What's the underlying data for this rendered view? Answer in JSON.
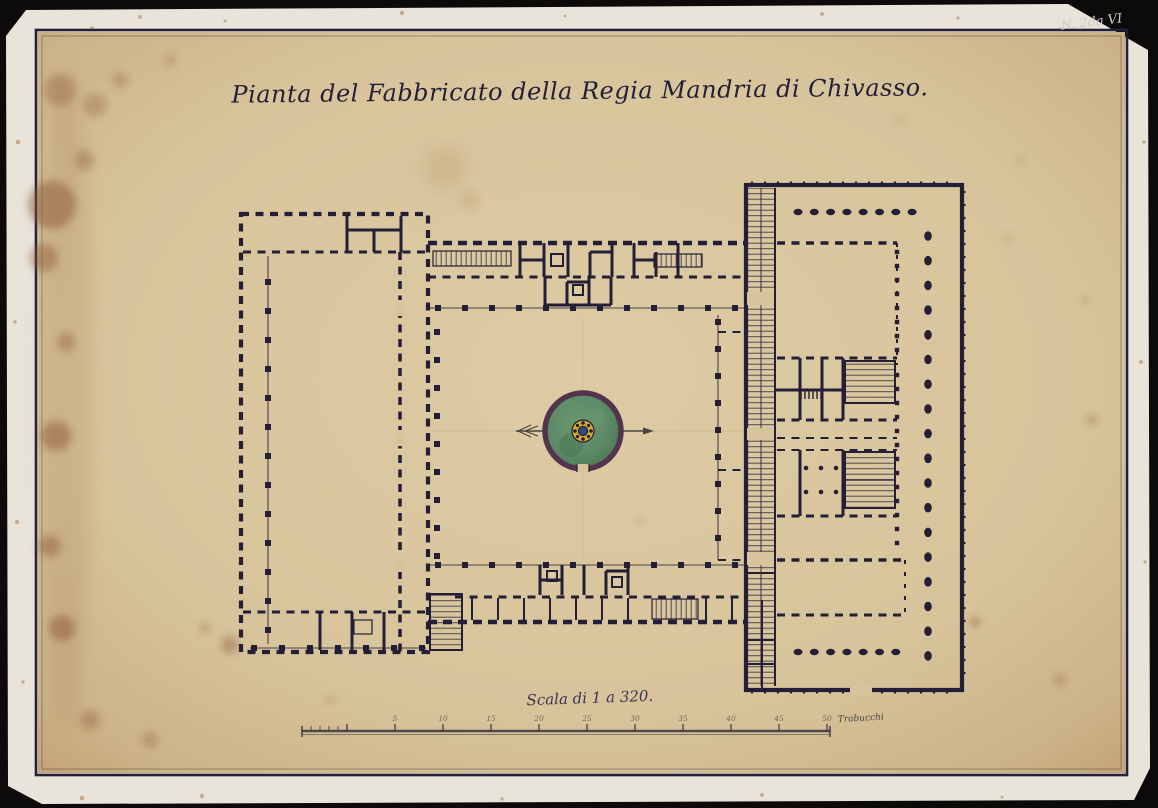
{
  "document": {
    "title": "Pianta del Fabbricato della Regia Mandria di Chivasso.",
    "corner_annotation": "N. 2da VI",
    "scale_caption": "Scala di 1 a 320.",
    "scale_unit_label": "Trabucchi",
    "scale_tick_labels": [
      "5",
      "10",
      "15",
      "20",
      "25",
      "30",
      "35",
      "40",
      "45",
      "50"
    ]
  },
  "colors": {
    "scan-bg": "#0c0b0a",
    "mount": "#e8e4da",
    "paper": "#d9c7a0",
    "paper-edge": "#c3a477",
    "ink": "#241e36",
    "stain": "#8a5730",
    "fountain-basin": "#5d8a66",
    "fountain-basin-dark": "#4a7a58",
    "fountain-rim": "#53344f",
    "fountain-center-yellow": "#d2aa2e",
    "fountain-center-blue": "#2c4b80",
    "annotation-ink": "#cfccc4",
    "pencil": "#8d8373"
  }
}
